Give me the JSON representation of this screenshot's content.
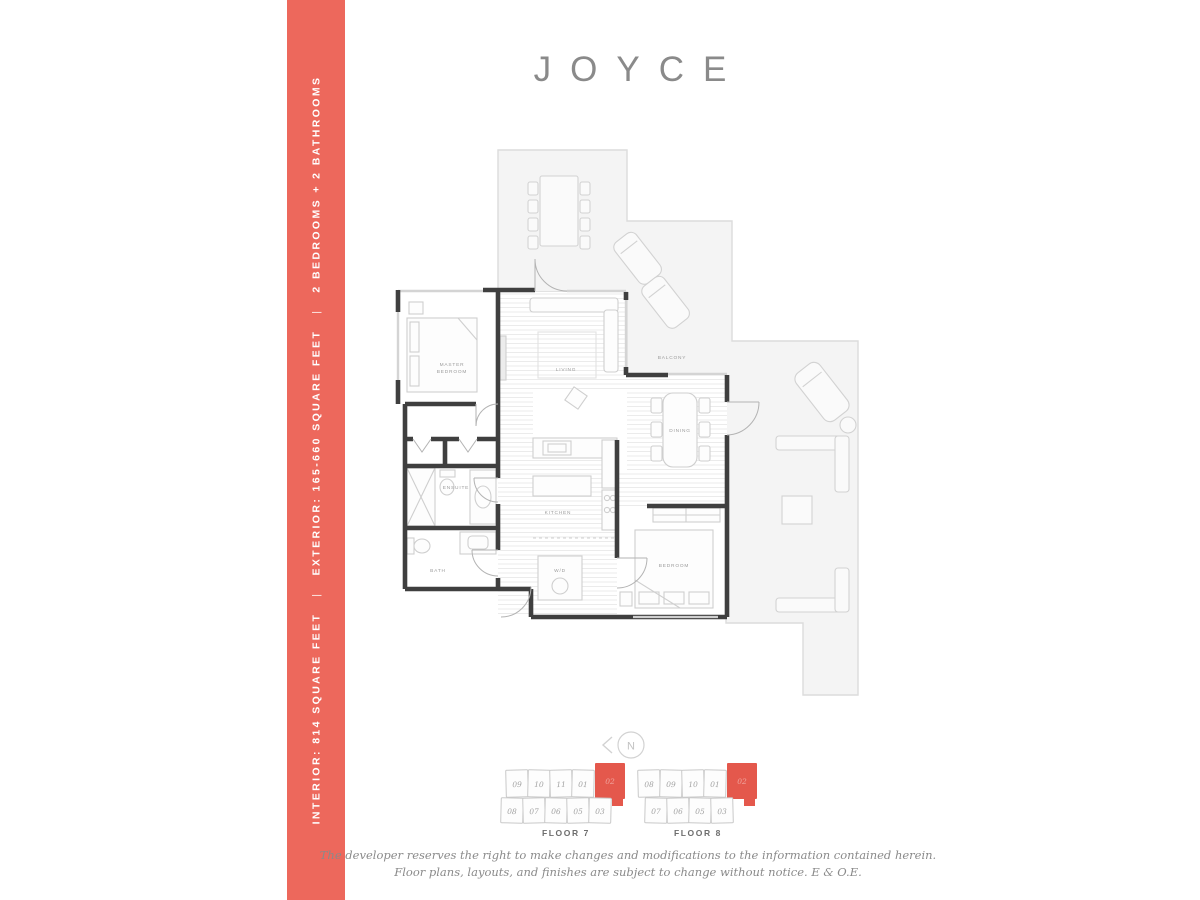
{
  "page": {
    "title": "JOYCE"
  },
  "colors": {
    "accent": "#ED685C",
    "accent_dark": "#E4584C",
    "title_gray": "#8A8A8A"
  },
  "sidebar": {
    "segments": [
      "INTERIOR: 814 SQUARE FEET",
      "EXTERIOR: 165-660 SQUARE FEET",
      "2 BEDROOMS + 2 BATHROOMS"
    ],
    "separator": "|"
  },
  "plan": {
    "rooms": {
      "master_line1": "MASTER",
      "master_line2": "BEDROOM",
      "living": "LIVING",
      "balcony": "BALCONY",
      "dining": "DINING",
      "kitchen": "KITCHEN",
      "ensuite": "ENSUITE",
      "bath": "BATH",
      "wd": "W/D",
      "bedroom": "BEDROOM"
    }
  },
  "compass": {
    "label": "N"
  },
  "floorplates": [
    {
      "label": "FLOOR 7",
      "top_row": [
        "09",
        "10",
        "11",
        "01"
      ],
      "highlight": "02",
      "bottom_row": [
        "08",
        "07",
        "06",
        "05",
        "03"
      ],
      "bottom_offset": 1
    },
    {
      "label": "FLOOR 8",
      "top_row": [
        "08",
        "09",
        "10",
        "01"
      ],
      "highlight": "02",
      "bottom_row": [
        "07",
        "06",
        "05",
        "03"
      ],
      "bottom_offset": 13
    }
  ],
  "disclaimer": {
    "line1": "The developer reserves the right to make changes and modifications to the information contained herein.",
    "line2": "Floor plans, layouts, and finishes are subject to change without notice. E & O.E."
  }
}
